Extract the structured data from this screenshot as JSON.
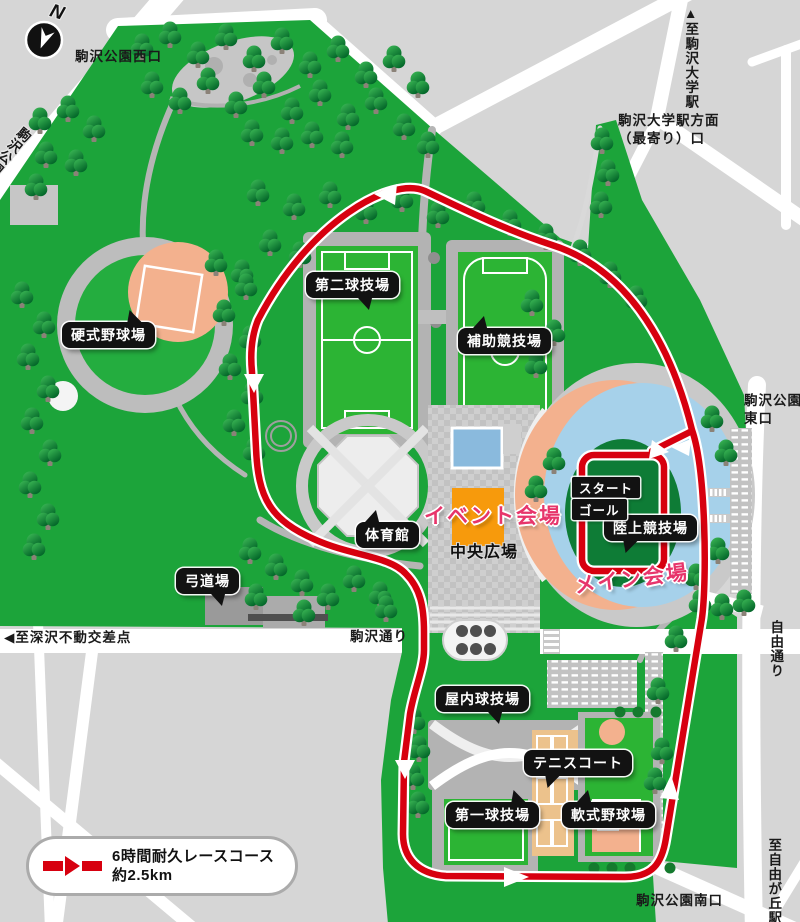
{
  "compass": {
    "label": "N"
  },
  "roads": {
    "west_gate": "駒沢公園西口",
    "park_street": "駒沢公園通り",
    "to_komazawa_univ_station": "▲至駒沢大学駅",
    "univ_station_entrance_line1": "駒沢大学駅方面",
    "univ_station_entrance_line2": "（最寄り）口",
    "east_gate_line1": "駒沢公園",
    "east_gate_line2": "東口",
    "jiyu_street": "自由通り",
    "to_jiyugaoka_station": "至自由が丘駅▼",
    "south_gate": "駒沢公園南口",
    "to_fukasawa_crossing": "◀至深沢不動交差点",
    "komazawa_street": "駒沢通り"
  },
  "facilities": {
    "hardball_field": "硬式野球場",
    "second_ball_field": "第二球技場",
    "auxiliary_track": "補助競技場",
    "gymnasium": "体育館",
    "kyudo_hall": "弓道場",
    "athletics_stadium": "陸上競技場",
    "indoor_ball_field": "屋内球技場",
    "tennis_courts": "テニスコート",
    "first_ball_field": "第一球技場",
    "softball_field": "軟式野球場"
  },
  "venues": {
    "start": "スタート",
    "goal": "ゴール",
    "event_venue": "イベント会場",
    "main_venue": "メイン会場",
    "central_plaza": "中央広場"
  },
  "legend": {
    "line1": "6時間耐久レースコース",
    "line2": "約2.5km"
  },
  "colors": {
    "course_red": "#d7000f",
    "venue_pink": "#e7356b",
    "event_orange": "#f79a0c",
    "park_green": "#1ca43a",
    "track_blue": "#a6d1ea",
    "infield_peach": "#f3b18e"
  }
}
